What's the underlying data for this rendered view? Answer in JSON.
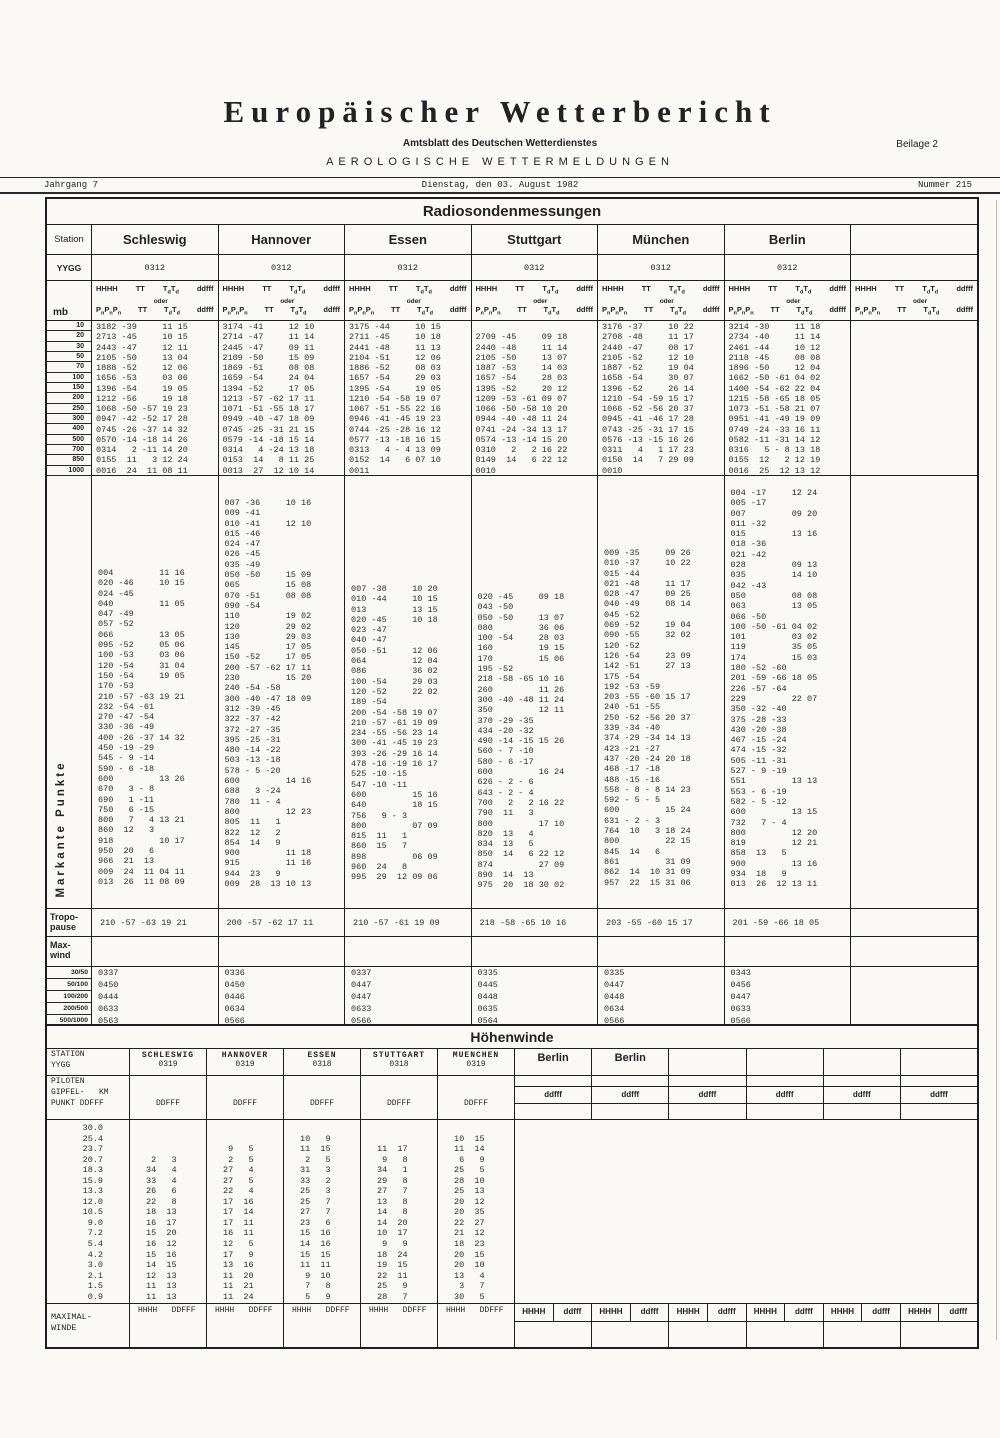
{
  "masthead": {
    "title": "Europäischer Wetterbericht",
    "subtitle": "Amtsblatt des Deutschen Wetterdienstes",
    "section": "AEROLOGISCHE WETTERMELDUNGEN",
    "beilage": "Beilage 2",
    "jahrgang": "Jahrgang 7",
    "date": "Dienstag, den 03. August 1982",
    "nummer": "Nummer 215"
  },
  "radiosonde": {
    "title": "Radiosondenmessungen",
    "station_label": "Station",
    "yygg_label": "YYGG",
    "mb_label": "mb",
    "markante_label": "Markante Punkte",
    "tropo_label_1": "Tropo-",
    "tropo_label_2": "pause",
    "maxwind_label_1": "Max-",
    "maxwind_label_2": "wind",
    "hdr": {
      "hhhh": "HHHH",
      "tt": "TT",
      "t": "T",
      "d": "d",
      "ddfff": "ddfff",
      "oder": "oder",
      "p": "P",
      "n": "n"
    },
    "mb_levels": [
      "10",
      "20",
      "30",
      "50",
      "70",
      "100",
      "150",
      "200",
      "250",
      "300",
      "400",
      "500",
      "700",
      "850",
      "1000"
    ],
    "ratio_labels": [
      "30/50",
      "50/100",
      "100/200",
      "200/500",
      "500/1000"
    ],
    "stations": [
      {
        "name": "Schleswig",
        "yygg": "0312",
        "levels": [
          "3182 -39     11 15",
          "2713 -45     10 15",
          "2443 -47     12 11",
          "2105 -50     13 04",
          "1888 -52     12 06",
          "1656 -53     03 06",
          "1396 -54     19 05",
          "1212 -56     19 18",
          "1068 -50 -57 19 23",
          "0947 -42 -52 17 28",
          "0745 -26 -37 14 32",
          "0570 -14 -18 14 26",
          "0314   2 -11 14 20",
          "0155  11   3 12 24",
          "0016  24  11 08 11"
        ],
        "markante": [
          "004         11 16",
          "020 -46     10 15",
          "024 -45",
          "040         11 05",
          "047 -49",
          "057 -52",
          "066         13 05",
          "095 -52     05 06",
          "100 -53     03 06",
          "120 -54     31 04",
          "150 -54     19 05",
          "170 -53",
          "210 -57 -63 19 21",
          "232 -54 -61",
          "270 -47 -54",
          "330 -36 -49",
          "400 -26 -37 14 32",
          "450 -19 -29",
          "545 - 9 -14",
          "590 - 6 -18",
          "600         13 26",
          "670   3 - 8",
          "690   1 -11",
          "750   6 -15",
          "800   7   4 13 21",
          "860  12   3",
          "918         10 17",
          "950  20   6",
          "966  21  13",
          "009  24  11 04 11",
          "013  26  11 08 09"
        ],
        "tropopause": "210 -57 -63 19 21",
        "ratios": [
          "0337",
          "0450",
          "0444",
          "0633",
          "0563"
        ]
      },
      {
        "name": "Hannover",
        "yygg": "0312",
        "levels": [
          "3174 -41     12 10",
          "2714 -47     11 14",
          "2445 -47     09 11",
          "2109 -50     15 09",
          "1869 -51     08 08",
          "1659 -54     24 04",
          "1394 -52     17 05",
          "1213 -57 -62 17 11",
          "1071 -51 -55 18 17",
          "0949 -40 -47 18 09",
          "0745 -25 -31 21 15",
          "0579 -14 -18 15 14",
          "0314   4 -24 13 18",
          "0153  14   8 11 25",
          "0013  27  12 10 14"
        ],
        "markante": [
          "007 -36     10 16",
          "009 -41",
          "010 -41     12 10",
          "015 -46",
          "024 -47",
          "026 -45",
          "035 -49",
          "050 -50     15 09",
          "065         15 08",
          "070 -51     08 08",
          "090 -54",
          "110         19 02",
          "120         29 02",
          "130         29 03",
          "145         17 05",
          "150 -52     17 05",
          "200 -57 -62 17 11",
          "230         15 20",
          "240 -54 -58",
          "300 -40 -47 18 09",
          "312 -39 -45",
          "322 -37 -42",
          "372 -27 -35",
          "395 -25 -31",
          "480 -14 -22",
          "503 -13 -18",
          "578 - 5 -20",
          "600         14 16",
          "688   3 -24",
          "780  11 - 4",
          "800         12 23",
          "805  11   1",
          "822  12   2",
          "854  14   9",
          "900         11 18",
          "915         11 16",
          "944  23   9",
          "009  28  13 10 13"
        ],
        "tropopause": "200 -57 -62 17 11",
        "ratios": [
          "0336",
          "0450",
          "0446",
          "0634",
          "0566"
        ]
      },
      {
        "name": "Essen",
        "yygg": "0312",
        "levels": [
          "3175 -44     10 15",
          "2711 -45     10 18",
          "2441 -48     11 13",
          "2104 -51     12 06",
          "1886 -52     08 03",
          "1657 -54     29 03",
          "1395 -54     19 05",
          "1210 -54 -58 19 07",
          "1067 -51 -55 22 16",
          "0946 -41 -45 19 23",
          "0744 -25 -28 16 12",
          "0577 -13 -18 16 15",
          "0313   4 - 4 13 09",
          "0152  14   6 07 10",
          "0011"
        ],
        "markante": [
          "007 -38     10 20",
          "010 -44     10 15",
          "013         13 15",
          "020 -45     10 18",
          "023 -47",
          "040 -47",
          "050 -51     12 06",
          "064         12 04",
          "086         36 02",
          "100 -54     29 03",
          "120 -52     22 02",
          "189 -54",
          "200 -54 -58 19 07",
          "210 -57 -61 19 09",
          "234 -55 -56 23 14",
          "300 -41 -45 19 23",
          "393 -26 -29 16 14",
          "478 -16 -19 16 17",
          "525 -10 -15",
          "547 -10 -11",
          "600         15 16",
          "640         18 15",
          "756   9 - 3",
          "800         07 09",
          "815  11   1",
          "860  15   7",
          "898         06 09",
          "960  24   8",
          "995  29  12 09 06"
        ],
        "tropopause": "210 -57 -61 19 09",
        "ratios": [
          "0337",
          "0447",
          "0447",
          "0633",
          "0566"
        ]
      },
      {
        "name": "Stuttgart",
        "yygg": "0312",
        "levels": [
          "",
          "2709 -45     09 18",
          "2440 -48     11 14",
          "2105 -50     13 07",
          "1887 -53     14 03",
          "1657 -54     28 03",
          "1395 -52     20 12",
          "1209 -53 -61 09 07",
          "1066 -50 -58 10 20",
          "0944 -40 -48 11 24",
          "0741 -24 -34 13 17",
          "0574 -13 -14 15 20",
          "0310   2   2 16 22",
          "0149  14   6 22 12",
          "0010"
        ],
        "markante": [
          "020 -45     09 18",
          "043 -50",
          "050 -50     13 07",
          "080         36 06",
          "100 -54     28 03",
          "160         19 15",
          "170         15 06",
          "195 -52",
          "218 -58 -65 10 16",
          "260         11 26",
          "300 -40 -48 11 24",
          "350         12 11",
          "370 -29 -35",
          "434 -20 -32",
          "490 -14 -15 15 26",
          "560 - 7 -10",
          "580 - 6 -17",
          "600         16 24",
          "626 - 2 - 6",
          "643 - 2 - 4",
          "700   2   2 16 22",
          "790  11   3",
          "800         17 10",
          "820  13   4",
          "834  13   5",
          "850  14   6 22 12",
          "874         27 09",
          "890  14  13",
          "975  20  18 30 02"
        ],
        "tropopause": "218 -58 -65 10 16",
        "ratios": [
          "0335",
          "0445",
          "0448",
          "0635",
          "0564"
        ]
      },
      {
        "name": "München",
        "yygg": "0312",
        "levels": [
          "3176 -37     10 22",
          "2708 -48     11 17",
          "2440 -47     08 17",
          "2105 -52     12 10",
          "1887 -52     19 04",
          "1658 -54     30 07",
          "1396 -52     26 14",
          "1210 -54 -59 15 17",
          "1066 -52 -56 20 37",
          "0945 -41 -46 17 28",
          "0743 -25 -31 17 15",
          "0576 -13 -15 16 26",
          "0311   4   1 17 23",
          "0150  14   7 29 09",
          "0010"
        ],
        "markante": [
          "009 -35     09 26",
          "010 -37     10 22",
          "015 -44",
          "021 -48     11 17",
          "028 -47     09 25",
          "040 -49     08 14",
          "045 -52",
          "069 -52     19 04",
          "090 -55     32 02",
          "120 -52",
          "126 -54     23 09",
          "142 -51     27 13",
          "175 -54",
          "192 -53 -59",
          "203 -55 -60 15 17",
          "240 -51 -55",
          "250 -52 -56 20 37",
          "339 -34 -40",
          "374 -29 -34 14 13",
          "423 -21 -27",
          "437 -20 -24 20 18",
          "468 -17 -18",
          "488 -15 -16",
          "558 - 8 - 8 14 23",
          "592 - 5 - 5",
          "600         15 24",
          "631 - 2 - 3",
          "764  10   3 18 24",
          "800         22 15",
          "845  14   6",
          "861         31 09",
          "862  14  10 31 09",
          "957  22  15 31 06"
        ],
        "tropopause": "203 -55 -60 15 17",
        "ratios": [
          "0335",
          "0447",
          "0448",
          "0634",
          "0566"
        ]
      },
      {
        "name": "Berlin",
        "yygg": "0312",
        "levels": [
          "3214 -30     11 18",
          "2734 -40     11 14",
          "2461 -44     10 12",
          "2118 -45     08 08",
          "1896 -50     12 04",
          "1662 -50 -61 04 02",
          "1400 -54 -62 22 04",
          "1215 -58 -65 18 05",
          "1073 -51 -58 21 07",
          "0951 -41 -49 19 09",
          "0749 -24 -33 16 11",
          "0582 -11 -31 14 12",
          "0316   5 - 8 13 18",
          "0155  12   2 12 19",
          "0016  25  12 13 12"
        ],
        "markante": [
          "004 -17     12 24",
          "005 -17",
          "007         09 20",
          "011 -32",
          "015         13 16",
          "018 -36",
          "021 -42",
          "028         09 13",
          "035         14 10",
          "042 -43",
          "050         08 08",
          "063         13 05",
          "066 -50",
          "100 -50 -61 04 02",
          "101         03 02",
          "119         35 05",
          "174         15 03",
          "180 -52 -60",
          "201 -59 -66 18 05",
          "226 -57 -64",
          "229         22 07",
          "350 -32 -40",
          "375 -28 -33",
          "430 -20 -38",
          "467 -15 -24",
          "474 -15 -32",
          "505 -11 -31",
          "527 - 9 -19",
          "551         13 13",
          "553 - 6 -19",
          "582 - 5 -12",
          "600         13 15",
          "732   7 - 4",
          "800         12 20",
          "819         12 21",
          "858  13   5",
          "900         13 16",
          "934  18   9",
          "013  26  12 13 11"
        ],
        "tropopause": "201 -59 -66 18 05",
        "ratios": [
          "0343",
          "0456",
          "0447",
          "0633",
          "0566"
        ]
      }
    ]
  },
  "hoehenwinde": {
    "title": "Höhenwinde",
    "station_label": "STATION",
    "yygg_label": "YYGG",
    "piloten_label": "PILOTEN",
    "gipfel_label": "GIPFEL-   KM",
    "punkt_label": "PUNKT DDFFF",
    "ddfff_label": "ddfff",
    "hhhh_label": "HHHH",
    "maximal_label_1": "MAXIMAL-",
    "maximal_label_2": "WINDE",
    "maximal_hdr": "HHHH   DDFFF",
    "altitudes": [
      "30.0",
      "25.4",
      "23.7",
      "20.7",
      "18.3",
      "15.9",
      "13.3",
      "12.0",
      "10.5",
      "9.0",
      "7.2",
      "5.4",
      "4.2",
      "3.0",
      "2.1",
      "1.5",
      "0.9"
    ],
    "stations": [
      {
        "name": "SCHLESWIG",
        "yygg": "0319",
        "piloten": "DDFFF",
        "gipfel": "27.2",
        "punkt": " 6   6",
        "winds": [
          "",
          "",
          "",
          " 2   3",
          "34   4",
          "33   4",
          "26   6",
          "22   8",
          "18  13",
          "16  17",
          "15  20",
          "16  12",
          "15  16",
          "14  15",
          "12  13",
          "11  13",
          "11  13"
        ]
      },
      {
        "name": "HANNOVER",
        "yygg": "0319",
        "piloten": "DDFFF",
        "gipfel": "24.6",
        "punkt": " 9   5",
        "winds": [
          "",
          "",
          " 9   5",
          " 2   5",
          "27   4",
          "27   5",
          "22   4",
          "17  16",
          "17  14",
          "17  11",
          "16  11",
          "12   5",
          "17   9",
          "13  16",
          "11  20",
          "11  21",
          "11  24"
        ]
      },
      {
        "name": "ESSEN",
        "yygg": "0318",
        "piloten": "DDFFF",
        "gipfel": "28.2",
        "punkt": "11   8",
        "winds": [
          "",
          "10   9",
          "11  15",
          " 2   5",
          "31   3",
          "33   2",
          "25   3",
          "25   7",
          "27   7",
          "23   6",
          "15  16",
          "14  16",
          "15  15",
          "11  11",
          " 9  10",
          " 7   8",
          " 5   9"
        ]
      },
      {
        "name": "STUTTGART",
        "yygg": "0318",
        "piloten": "DDFFF",
        "gipfel": "23.7",
        "punkt": "11  17",
        "winds": [
          "",
          "",
          "11  17",
          " 9   8",
          "34   1",
          "29   8",
          "27   7",
          "13   8",
          "14   8",
          "14  20",
          "10  17",
          " 9   9",
          "18  24",
          "19  15",
          "22  11",
          "25   9",
          "28   7"
        ]
      },
      {
        "name": "MUENCHEN",
        "yygg": "0319",
        "piloten": "DDFFF",
        "gipfel": "27.3",
        "punkt": " 8  21",
        "winds": [
          "",
          "10  15",
          "11  14",
          " 6   9",
          "25   5",
          "28  10",
          "25  13",
          "20  12",
          "20  35",
          "22  27",
          "21  12",
          "18  23",
          "20  15",
          "20  10",
          "13   4",
          " 3   7",
          "30   5"
        ]
      }
    ],
    "right_cols": [
      {
        "title": "Berlin"
      },
      {
        "title": "Berlin"
      },
      {
        "title": ""
      },
      {
        "title": ""
      },
      {
        "title": ""
      },
      {
        "title": ""
      }
    ]
  }
}
